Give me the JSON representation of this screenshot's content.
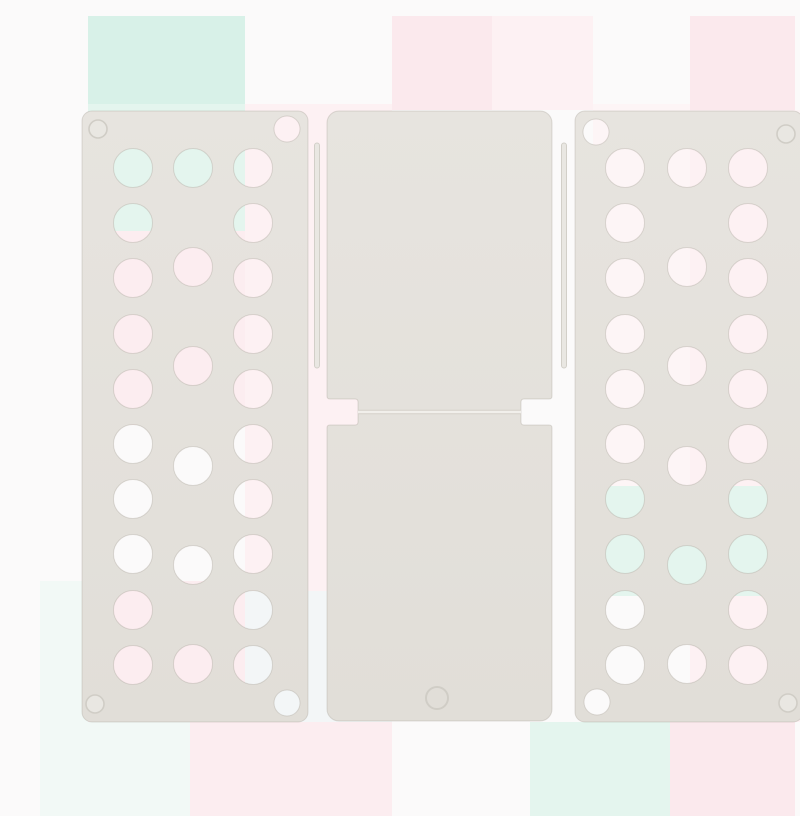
{
  "scene": {
    "type": "product-photo",
    "subject": "White plastic T-shirt folding board (flip-fold laundry folder) shown unfolded from above on a pastel checkered backdrop",
    "background_style": "soft pastel checkered backdrop (white, pink, mint squares)"
  },
  "colors": {
    "backdrop_base": "#fbfafa",
    "panel_top": "#e7e4df",
    "panel_bottom": "#e1ded8",
    "panel_edge": "rgba(150,144,132,0.28)",
    "hinge_rod_fill": "#e9e7e2",
    "hinge_rod_edge": "#d2cfc8",
    "groove_dark": "#d4d1ca",
    "groove_light": "#f1efeb",
    "ring_stroke": "#d0cdc6",
    "ring_fill": "#e9e7e2",
    "mint_strong": "#d8f1e8",
    "mint_light": "#e4f5ee",
    "mint_pale": "#f2f9f6",
    "pink": "#fbe9ed",
    "pink_mid": "#fcedf0",
    "pink_pale": "#fdf1f3",
    "pink_faint": "#fdf5f6",
    "blue_pale": "#f3f6f7"
  },
  "backdrop_squares": [
    {
      "x": 48,
      "y": 0,
      "w": 157,
      "h": 88,
      "c": "mint_strong"
    },
    {
      "x": 48,
      "y": 88,
      "w": 157,
      "h": 127,
      "c": "mint_light"
    },
    {
      "x": 352,
      "y": 0,
      "w": 100,
      "h": 94,
      "c": "pink"
    },
    {
      "x": 452,
      "y": 0,
      "w": 101,
      "h": 94,
      "c": "pink_pale"
    },
    {
      "x": 650,
      "y": 0,
      "w": 105,
      "h": 94,
      "c": "pink"
    },
    {
      "x": 48,
      "y": 215,
      "w": 157,
      "h": 194,
      "c": "pink_mid"
    },
    {
      "x": 205,
      "y": 88,
      "w": 147,
      "h": 487,
      "c": "pink_pale"
    },
    {
      "x": 205,
      "y": 575,
      "w": 147,
      "h": 131,
      "c": "blue_pale"
    },
    {
      "x": 48,
      "y": 565,
      "w": 157,
      "h": 141,
      "c": "pink_mid"
    },
    {
      "x": 0,
      "y": 565,
      "w": 48,
      "h": 141,
      "c": "mint_pale"
    },
    {
      "x": 0,
      "y": 706,
      "w": 150,
      "h": 94,
      "c": "mint_pale"
    },
    {
      "x": 150,
      "y": 706,
      "w": 202,
      "h": 94,
      "c": "pink_mid"
    },
    {
      "x": 490,
      "y": 706,
      "w": 140,
      "h": 94,
      "c": "mint_light"
    },
    {
      "x": 630,
      "y": 706,
      "w": 125,
      "h": 94,
      "c": "pink"
    },
    {
      "x": 553,
      "y": 88,
      "w": 97,
      "h": 382,
      "c": "pink_faint"
    },
    {
      "x": 650,
      "y": 94,
      "w": 105,
      "h": 376,
      "c": "pink_pale"
    },
    {
      "x": 755,
      "y": 94,
      "w": 45,
      "h": 150,
      "c": "pink_faint"
    },
    {
      "x": 553,
      "y": 470,
      "w": 247,
      "h": 110,
      "c": "mint_light"
    },
    {
      "x": 650,
      "y": 580,
      "w": 150,
      "h": 126,
      "c": "pink_pale"
    }
  ],
  "board": {
    "corner_radius": 10,
    "hole_radius": 19.5,
    "corner_hole_radius": 13,
    "corner_ring_radius": 9,
    "left_wing": {
      "x": 42,
      "y": 95,
      "w": 226,
      "h": 611
    },
    "right_wing": {
      "x": 535,
      "y": 95,
      "w": 228,
      "h": 611
    },
    "center_panel": {
      "x": 287,
      "y": 95,
      "w": 225,
      "h": 610,
      "notch_top": 383,
      "notch_bottom": 409,
      "notch_depth": 31,
      "groove_y": 396
    },
    "left_cols": [
      93,
      153,
      213
    ],
    "right_cols": [
      585,
      647,
      708
    ],
    "rows_outer_cols": [
      152,
      207,
      262,
      318,
      373,
      428,
      483,
      538,
      594,
      649
    ],
    "rows_middle_col": [
      152,
      251,
      350,
      450,
      549,
      648
    ],
    "corner_holes": [
      {
        "cx": 247,
        "cy": 113
      },
      {
        "cx": 247,
        "cy": 687
      },
      {
        "cx": 556,
        "cy": 116
      },
      {
        "cx": 557,
        "cy": 686
      }
    ],
    "corner_rings": [
      {
        "cx": 58,
        "cy": 113
      },
      {
        "cx": 55,
        "cy": 688
      },
      {
        "cx": 746,
        "cy": 118
      },
      {
        "cx": 748,
        "cy": 687
      }
    ],
    "center_ring": {
      "cx": 397,
      "cy": 682,
      "r": 11
    },
    "hinge_rods": [
      {
        "x": 277,
        "y1": 127,
        "y2": 352,
        "w": 5
      },
      {
        "x": 524,
        "y1": 127,
        "y2": 352,
        "w": 5
      }
    ]
  }
}
